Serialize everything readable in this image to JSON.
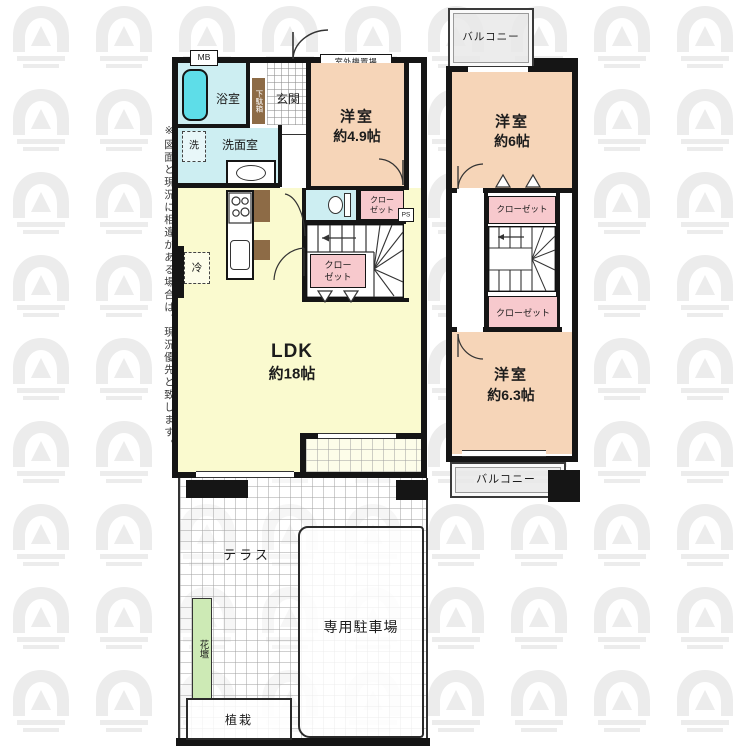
{
  "colors": {
    "wall": "#151515",
    "room_peach": "#f6d5b8",
    "room_yellow": "#fafacf",
    "closet_pink": "#f7c9cd",
    "wet_cyan": "#cdeef2",
    "tub_cyan": "#5edde8",
    "balcony_gray": "#ebebeb",
    "flower_green": "#cdeab5",
    "wood_brown": "#8d6b46",
    "watermark_gray": "#ececec"
  },
  "note": "※図面と現況に相違がある場合は、現況優先と致します。",
  "floor1": {
    "mb": "MB",
    "bathroom": "浴室",
    "shoe_cabinet": "下駄箱",
    "entrance": "玄関",
    "washroom": "洗面室",
    "washer": "洗",
    "outdoor_unit": "室外機置場",
    "western_room": {
      "name": "洋室",
      "size": "約4.9帖"
    },
    "closet_ps": {
      "line1": "クロー",
      "line2": "ゼット",
      "ps": "PS"
    },
    "hall_closet": {
      "line1": "クロー",
      "line2": "ゼット"
    },
    "fridge": "冷",
    "ldk": {
      "name": "LDK",
      "size": "約18帖"
    }
  },
  "floor2": {
    "balcony_top": "バルコニー",
    "western_room_6": {
      "name": "洋室",
      "size": "約6帖"
    },
    "closet_upper": "クローゼット",
    "closet_lower": "クローゼット",
    "western_room_63": {
      "name": "洋室",
      "size": "約6.3帖"
    },
    "balcony_bottom": "バルコニー"
  },
  "outdoor": {
    "terrace": "テラス",
    "parking": "専用駐車場",
    "flower_bed": "花壇",
    "planting": "植栽"
  }
}
